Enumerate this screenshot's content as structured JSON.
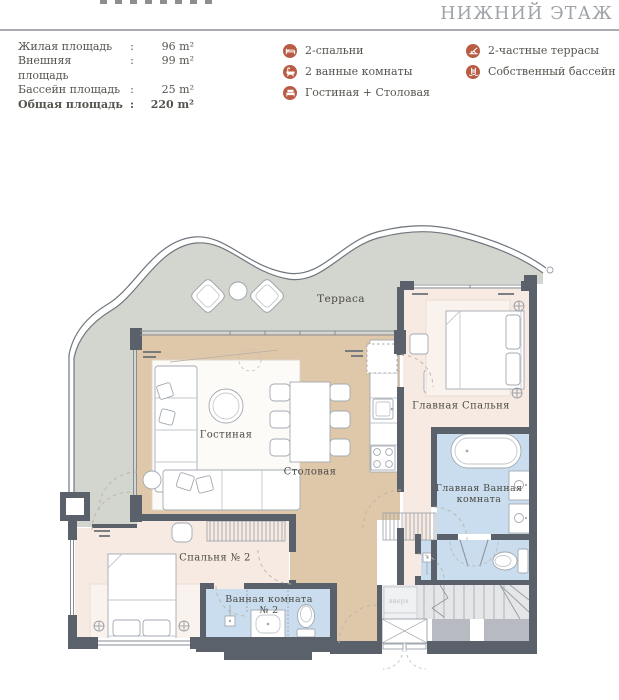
{
  "header": {
    "title": "НИЖНИЙ ЭТАЖ"
  },
  "stats": {
    "colon": ":",
    "rows": [
      {
        "label": "Жилая площадь",
        "value": "96 m²"
      },
      {
        "label": "Внешняя площадь",
        "value": "99 m²"
      },
      {
        "label": "Бассейн площадь",
        "value": "25 m²"
      },
      {
        "label": "Общая площадь",
        "value": "220 m²"
      }
    ]
  },
  "legend": {
    "columns": [
      [
        {
          "icon": "bed-icon",
          "label": "2-спальни"
        },
        {
          "icon": "bathtub-icon",
          "label": "2 ванные комнаты"
        },
        {
          "icon": "sofa-icon",
          "label": "Гостиная + Столовая"
        }
      ],
      [
        {
          "icon": "deck-chair-icon",
          "label": "2-частные террасы"
        },
        {
          "icon": "pool-icon",
          "label": "Собственный бассейн"
        }
      ]
    ]
  },
  "plan": {
    "labels": {
      "terrace": "Терраса",
      "living_room": "Гостиная",
      "dining_room": "Столовая",
      "master_bedroom": "Главная Спальня",
      "master_bathroom": "Главная Ванная комната",
      "bedroom_2": "Спальня № 2",
      "bathroom_2": "Ванная комната № 2",
      "stairs_up": "вверх"
    }
  },
  "colors": {
    "accent": "#b85d43",
    "wall": "#5b616b",
    "terrace_floor": "#d3d6ce",
    "living_floor": "#dfc8aa",
    "bedroom_floor": "#f6eae2",
    "bathroom_floor": "#c9ddee",
    "heading": "#9ea3a8"
  }
}
